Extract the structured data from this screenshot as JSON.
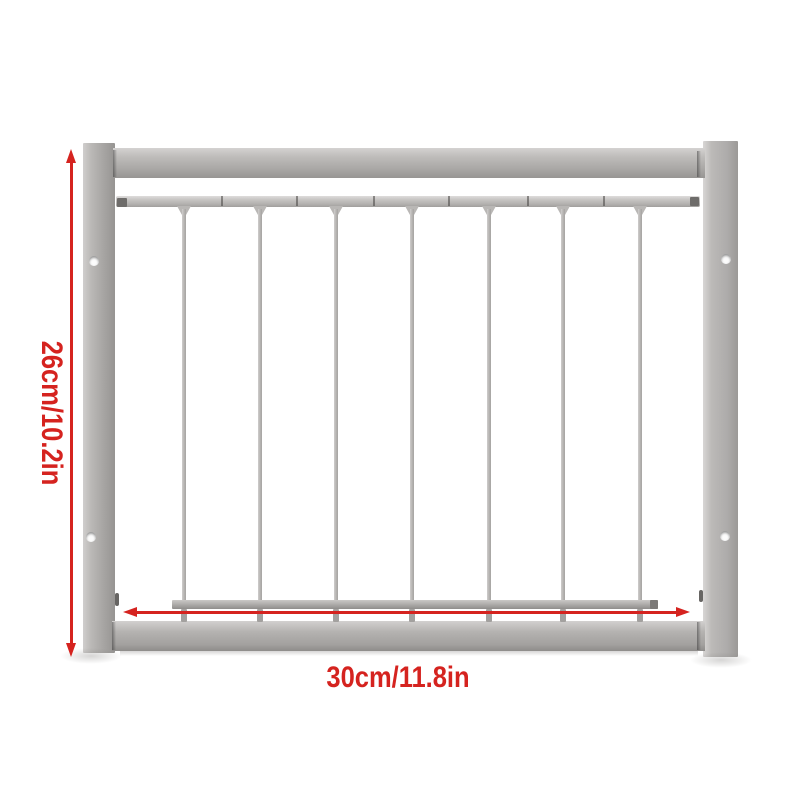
{
  "subject": "Gray metal extendable gate panel product photo with red dimension arrows",
  "colors": {
    "background": "#ffffff",
    "accent_red": "#d5231f",
    "frame_light": "#d3d1d0",
    "frame_mid": "#aeacaa",
    "frame_dark": "#8f8d8b"
  },
  "annotations": {
    "height_label": "26cm/10.2in",
    "width_label": "30cm/11.8in"
  },
  "gate": {
    "bar_count": 7,
    "bar_positions_x": [
      184,
      260,
      336,
      412,
      489,
      563,
      640
    ],
    "rail_seam_positions_x": [
      221,
      296,
      373,
      448,
      527,
      603
    ],
    "screw_holes": [
      {
        "x": 94,
        "y": 261
      },
      {
        "x": 726,
        "y": 259
      },
      {
        "x": 91,
        "y": 537
      },
      {
        "x": 725,
        "y": 536
      }
    ]
  }
}
